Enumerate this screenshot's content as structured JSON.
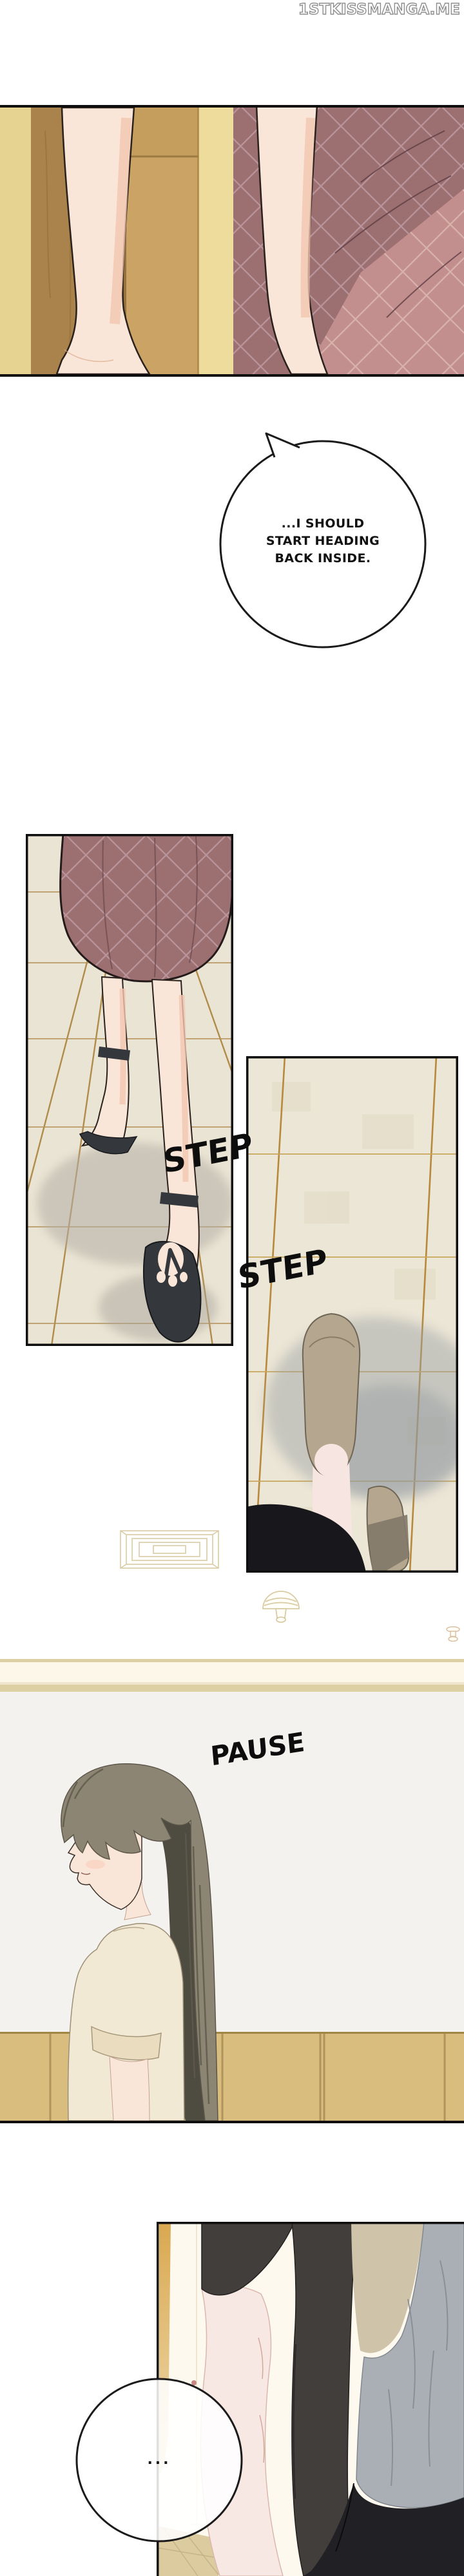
{
  "watermark": "1STKISSMANGA.ME",
  "speech_bubbles": {
    "bubble1": {
      "lines": [
        "...I SHOULD",
        "START HEADING",
        "BACK INSIDE."
      ]
    },
    "bubble2": {
      "text": "..."
    }
  },
  "sfx": {
    "step1": "STEP",
    "step2": "STEP",
    "pause": "PAUSE"
  },
  "colors": {
    "ink": "#0e0e0e",
    "skin": "#fae6d8",
    "skinShade": "#f2c7b1",
    "plaidBase": "#9c6f71",
    "plaidLine": "#b9959b",
    "plaidLight": "#c38f8e",
    "plaidLightLine": "#d8b2ac",
    "woodLight": "#e7d391",
    "wood": "#a9834b",
    "woodMid": "#c59e5e",
    "woodPale": "#eedc9d",
    "tile": "#eae4d4",
    "grout": "#a87c33",
    "groutGold": "#b8893a",
    "shadow": "#a9a59c",
    "slipper": "#b5a68f",
    "slipperDark": "#837a6a",
    "sandal": "#34373c",
    "wall": "#f4f2ee",
    "molding": "#ddd0a2",
    "moldingCream": "#fcf7e8",
    "cabinet": "#d8bd7f",
    "cabinetSeam": "#b1945a",
    "hairLight": "#8c8573",
    "hairMid": "#6e6a5b",
    "hairDark": "#4e4b41",
    "topCream": "#f2e9d5",
    "hallway": "#fdf9ef",
    "doorGold": "#d9a850",
    "jacket": "#413e3b",
    "shirt": "#aaafb5",
    "beigeVest": "#cfc3a9",
    "pants": "#212024",
    "armPink": "#f7e8e3",
    "legPink": "#f6e5e0"
  }
}
